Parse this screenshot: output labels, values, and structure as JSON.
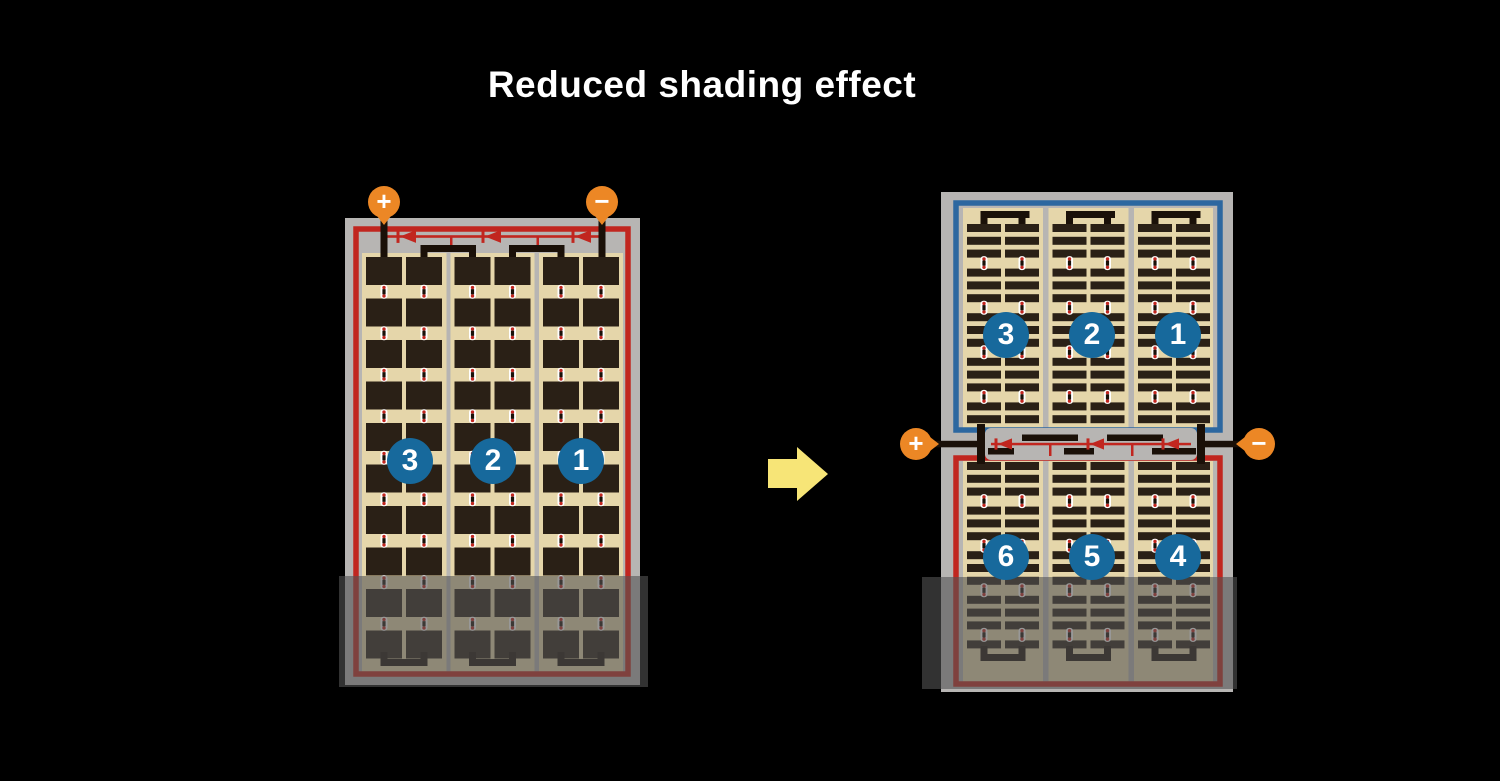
{
  "title": "Reduced shading effect",
  "terminals": {
    "plus_label": "+",
    "minus_label": "−"
  },
  "left_panel": {
    "string_labels": [
      "3",
      "2",
      "1"
    ]
  },
  "right_panel": {
    "top_string_labels": [
      "3",
      "2",
      "1"
    ],
    "bottom_string_labels": [
      "6",
      "5",
      "4"
    ]
  },
  "colors": {
    "background": "#000000",
    "title_text": "#ffffff",
    "frame_gray": "#b7b5b3",
    "panel_tan": "#e5d6aa",
    "cell_dark": "#2a2016",
    "busbar_black": "#1a1008",
    "red_border": "#c1261f",
    "blue_border": "#2c67a0",
    "diode_red": "#c1261f",
    "terminal_orange": "#ec8725",
    "badge_blue": "#17699c",
    "badge_text": "#ffffff",
    "connector_white": "#ffffff",
    "connector_red": "#c1261f",
    "shade_overlay": "rgba(84,84,84,0.6)",
    "arrow_yellow": "#f7e577"
  }
}
